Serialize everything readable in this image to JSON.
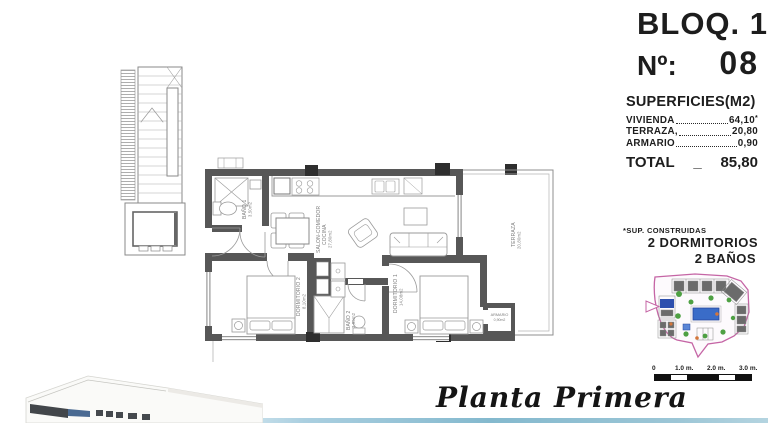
{
  "header": {
    "block": "BLOQ. 1",
    "number_label": "Nº:",
    "number_value": "08"
  },
  "surfaces": {
    "title": "SUPERFICIES(M2)",
    "rows": [
      {
        "name": "VIVIENDA",
        "value": "64,10",
        "note": "*"
      },
      {
        "name": "TERRAZA,",
        "value": "20,80",
        "note": ""
      },
      {
        "name": "ARMARIO",
        "value": "0,90",
        "note": ""
      }
    ],
    "total_label": "TOTAL",
    "total_separator": "_",
    "total_value": "85,80",
    "footnote": "*SUP. CONSTRUIDAS",
    "features": [
      "2 DORMITORIOS",
      "2 BAÑOS"
    ]
  },
  "plan": {
    "rooms": {
      "salon": {
        "name_line1": "SALON-COMEDOR",
        "name_line2": "COCINA",
        "area": "27,80m2"
      },
      "terraza": {
        "name": "TERRAZA",
        "area": "20,80m2"
      },
      "dormitorio1": {
        "name": "DORMITORIO 1",
        "area": "14,08m2"
      },
      "dormitorio2": {
        "name": "DORMITORIO 2",
        "area": "8,10m2"
      },
      "banio1": {
        "name": "BAÑO 1",
        "area": "3,50m2"
      },
      "banio2": {
        "name": "BAÑO 2",
        "area": "3,95m2"
      },
      "armario": {
        "name": "ARMARIO",
        "area": "0,90m2"
      }
    }
  },
  "sitemap": {
    "scale_labels": [
      "0",
      "1.0 m.",
      "2.0 m.",
      "3.0 m."
    ]
  },
  "footer": {
    "floor_title": "Planta Primera"
  }
}
